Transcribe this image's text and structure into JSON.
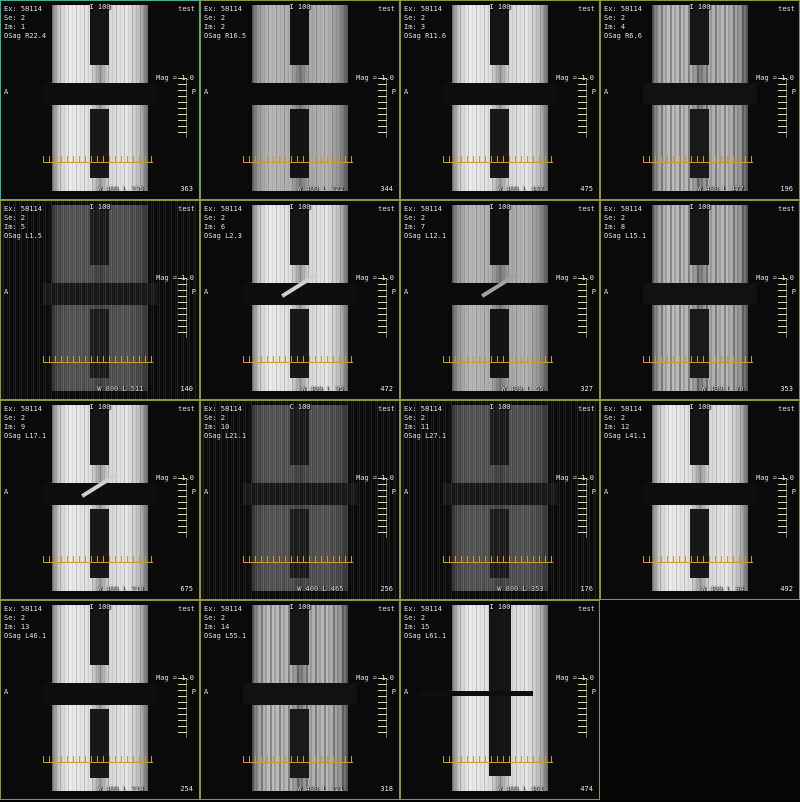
{
  "viewer": {
    "description": "MRI multi-image series browser, 4x4 tile layout, 15 oblique-sagittal phantom images",
    "grid_rows": 4,
    "grid_cols": 4,
    "border_color": "#8f9434",
    "selected_border_color": "#39b39b",
    "ruler_color": "#c79a33"
  },
  "cells": [
    {
      "ex": "Ex: 58114",
      "se": "Se: 2",
      "im": "Im: 1",
      "osag": "OSag R22.4",
      "loc": "I 100",
      "corner": "test",
      "mag": "Mag = 1.0",
      "left_marker": "A",
      "right_marker": "P",
      "wl": "W 400 L 235",
      "num": "363",
      "variant": "bright",
      "diag": false,
      "selected": true
    },
    {
      "ex": "Ex: 58114",
      "se": "Se: 2",
      "im": "Im: 2",
      "osag": "OSag R16.5",
      "loc": "I 100",
      "corner": "test",
      "mag": "Mag = 1.0",
      "left_marker": "A",
      "right_marker": "P",
      "wl": "W 400 L 222",
      "num": "344",
      "variant": "medium",
      "diag": false,
      "selected": false
    },
    {
      "ex": "Ex: 58114",
      "se": "Se: 2",
      "im": "Im: 3",
      "osag": "OSag R11.6",
      "loc": "I 100",
      "corner": "test",
      "mag": "Mag = 1.0",
      "left_marker": "A",
      "right_marker": "P",
      "wl": "W 400 L 447",
      "num": "475",
      "variant": "bright",
      "diag": false,
      "selected": false
    },
    {
      "ex": "Ex: 58114",
      "se": "Se: 2",
      "im": "Im: 4",
      "osag": "OSag R6.6",
      "loc": "I 100",
      "corner": "test",
      "mag": "Mag = 1.0",
      "left_marker": "A",
      "right_marker": "P",
      "wl": "W 400 L 477",
      "num": "196",
      "variant": "striped",
      "diag": false,
      "selected": false
    },
    {
      "ex": "Ex: 58114",
      "se": "Se: 2",
      "im": "Im: 5",
      "osag": "OSag L1.5",
      "loc": "I 100",
      "corner": "test",
      "mag": "Mag = 1.0",
      "left_marker": "A",
      "right_marker": "P",
      "wl": "W 800 L 511",
      "num": "140",
      "variant": "dark",
      "diag": false,
      "selected": false
    },
    {
      "ex": "Ex: 58114",
      "se": "Se: 2",
      "im": "Im: 6",
      "osag": "OSag L2.3",
      "loc": "I 100",
      "corner": "test",
      "mag": "Mag = 1.0",
      "left_marker": "A",
      "right_marker": "P",
      "wl": "W 400 L 95",
      "num": "472",
      "variant": "bright",
      "diag": true,
      "selected": false
    },
    {
      "ex": "Ex: 58114",
      "se": "Se: 2",
      "im": "Im: 7",
      "osag": "OSag L12.1",
      "loc": "I 100",
      "corner": "test",
      "mag": "Mag = 1.0",
      "left_marker": "A",
      "right_marker": "P",
      "wl": "W 400 L 55",
      "num": "327",
      "variant": "medium",
      "diag": true,
      "selected": false
    },
    {
      "ex": "Ex: 58114",
      "se": "Se: 2",
      "im": "Im: 8",
      "osag": "OSag L15.1",
      "loc": "I 100",
      "corner": "test",
      "mag": "Mag = 1.0",
      "left_marker": "A",
      "right_marker": "P",
      "wl": "W 400 L 70",
      "num": "353",
      "variant": "striped",
      "diag": false,
      "selected": false
    },
    {
      "ex": "Ex: 58114",
      "se": "Se: 2",
      "im": "Im: 9",
      "osag": "OSag L17.1",
      "loc": "I 100",
      "corner": "test",
      "mag": "Mag = 1.0",
      "left_marker": "A",
      "right_marker": "P",
      "wl": "W 400 L 218",
      "num": "675",
      "variant": "bright",
      "diag": true,
      "selected": false
    },
    {
      "ex": "Ex: 58114",
      "se": "Se: 2",
      "im": "Im: 10",
      "osag": "OSag L21.1",
      "loc": "C 100",
      "corner": "test",
      "mag": "Mag = 1.0",
      "left_marker": "A",
      "right_marker": "P",
      "wl": "W 400 L 465",
      "num": "256",
      "variant": "dark",
      "diag": false,
      "selected": false
    },
    {
      "ex": "Ex: 58114",
      "se": "Se: 2",
      "im": "Im: 11",
      "osag": "OSag L27.1",
      "loc": "I 100",
      "corner": "test",
      "mag": "Mag = 1.0",
      "left_marker": "A",
      "right_marker": "P",
      "wl": "W 800 L 353",
      "num": "176",
      "variant": "dark",
      "diag": false,
      "selected": false
    },
    {
      "ex": "Ex: 58114",
      "se": "Se: 2",
      "im": "Im: 12",
      "osag": "OSag L41.1",
      "loc": "I 100",
      "corner": "test",
      "mag": "Mag = 1.0",
      "left_marker": "A",
      "right_marker": "P",
      "wl": "W 400 L 84",
      "num": "492",
      "variant": "bright",
      "diag": false,
      "selected": false
    },
    {
      "ex": "Ex: 58114",
      "se": "Se: 2",
      "im": "Im: 13",
      "osag": "OSag L46.1",
      "loc": "I 100",
      "corner": "test",
      "mag": "Mag = 1.0",
      "left_marker": "A",
      "right_marker": "P",
      "wl": "W 400 L 214",
      "num": "254",
      "variant": "bright",
      "diag": false,
      "selected": false
    },
    {
      "ex": "Ex: 58114",
      "se": "Se: 2",
      "im": "Im: 14",
      "osag": "OSag L55.1",
      "loc": "I 100",
      "corner": "test",
      "mag": "Mag = 1.0",
      "left_marker": "A",
      "right_marker": "P",
      "wl": "W 400 L 221",
      "num": "318",
      "variant": "striped",
      "diag": false,
      "selected": false
    },
    {
      "ex": "Ex: 58114",
      "se": "Se: 2",
      "im": "Im: 15",
      "osag": "OSag L61.1",
      "loc": "I 100",
      "corner": "test",
      "mag": "Mag = 1.0",
      "left_marker": "A",
      "right_marker": "P",
      "wl": "W 400 L 461",
      "num": "474",
      "variant": "narrow",
      "diag": false,
      "selected": false
    }
  ]
}
